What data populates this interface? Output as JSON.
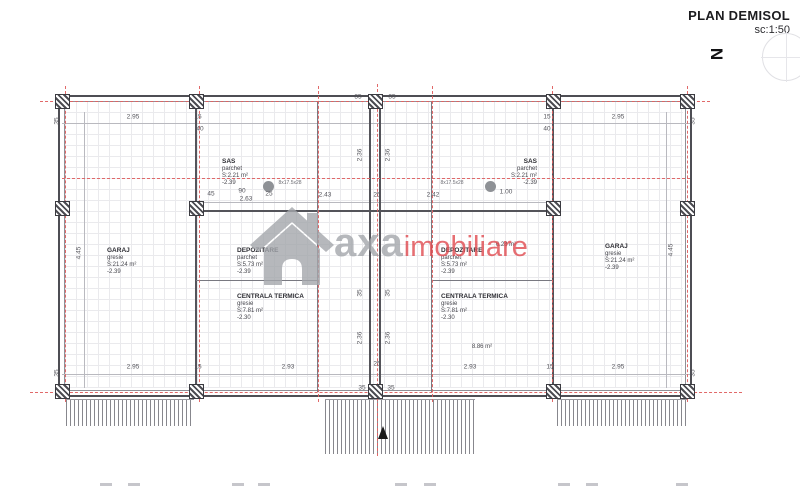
{
  "header": {
    "title": "PLAN DEMISOL",
    "scale": "sc:1:50",
    "north_letter": "N"
  },
  "watermark": {
    "brand": "axa",
    "suffix": "imobiliare",
    "grey_color": "#a4a7ac",
    "red_color": "#e04a50"
  },
  "rooms": [
    {
      "name": "GARAJ",
      "finish": "gresie",
      "area": "S:21.24 m²",
      "level": "-2.39",
      "x": 107,
      "y": 247,
      "align": "left"
    },
    {
      "name": "DEPOZITARE",
      "finish": "parchet",
      "area": "S:5.73 m²",
      "level": "-2.39",
      "x": 237,
      "y": 247,
      "align": "left"
    },
    {
      "name": "CENTRALA TERMICA",
      "finish": "gresie",
      "area": "S:7.81 m²",
      "level": "-2.30",
      "x": 237,
      "y": 293,
      "align": "left"
    },
    {
      "name": "SAS",
      "finish": "parchet",
      "area": "S:2.21 m²",
      "level": "-2.39",
      "x": 222,
      "y": 158,
      "align": "left"
    },
    {
      "name": "SAS",
      "finish": "parchet",
      "area": "S:2.21 m²",
      "level": "-2.39",
      "x": 537,
      "y": 158,
      "align": "right"
    },
    {
      "name": "DEPOZITARE",
      "finish": "parchet",
      "area": "S:5.73 m²",
      "level": "-2.39",
      "x": 441,
      "y": 247,
      "align": "left"
    },
    {
      "name": "CENTRALA TERMICA",
      "finish": "gresie",
      "area": "S:7.81 m²",
      "level": "-2.30",
      "x": 441,
      "y": 293,
      "align": "left"
    },
    {
      "name": "GARAJ",
      "finish": "gresie",
      "area": "S:21.24 m²",
      "level": "-2.39",
      "x": 605,
      "y": 243,
      "align": "left"
    }
  ],
  "annotations": [
    {
      "text": "6.28 m²",
      "x": 506,
      "y": 245,
      "small": 0
    },
    {
      "text": "8.86 m²",
      "x": 482,
      "y": 347,
      "small": 0
    },
    {
      "text": "8x17.5x28",
      "x": 290,
      "y": 183,
      "small": 1
    },
    {
      "text": "8x17.5x28",
      "x": 452,
      "y": 183,
      "small": 1
    }
  ],
  "dim_labels": [
    {
      "t": "2.95",
      "x": 133,
      "y": 117
    },
    {
      "t": "15",
      "x": 198,
      "y": 117
    },
    {
      "t": "15",
      "x": 547,
      "y": 117
    },
    {
      "t": "2.95",
      "x": 618,
      "y": 117
    },
    {
      "t": "35",
      "x": 57,
      "y": 121,
      "r": 1
    },
    {
      "t": "35",
      "x": 693,
      "y": 121,
      "r": 1
    },
    {
      "t": "40",
      "x": 200,
      "y": 129
    },
    {
      "t": "40",
      "x": 547,
      "y": 129
    },
    {
      "t": "35",
      "x": 358,
      "y": 97
    },
    {
      "t": "35",
      "x": 392,
      "y": 97
    },
    {
      "t": "45",
      "x": 211,
      "y": 194
    },
    {
      "t": "90",
      "x": 242,
      "y": 191
    },
    {
      "t": "2.63",
      "x": 246,
      "y": 199
    },
    {
      "t": "25",
      "x": 269,
      "y": 194
    },
    {
      "t": "2.43",
      "x": 325,
      "y": 195
    },
    {
      "t": "25",
      "x": 377,
      "y": 195
    },
    {
      "t": "2.42",
      "x": 433,
      "y": 195
    },
    {
      "t": "1.00",
      "x": 506,
      "y": 192
    },
    {
      "t": "4.45",
      "x": 79,
      "y": 253,
      "r": 1
    },
    {
      "t": "4.45",
      "x": 671,
      "y": 250,
      "r": 1
    },
    {
      "t": "2.36",
      "x": 360,
      "y": 155,
      "r": 1
    },
    {
      "t": "2.36",
      "x": 388,
      "y": 155,
      "r": 1
    },
    {
      "t": "35",
      "x": 360,
      "y": 293,
      "r": 1
    },
    {
      "t": "35",
      "x": 388,
      "y": 293,
      "r": 1
    },
    {
      "t": "2.36",
      "x": 360,
      "y": 338,
      "r": 1
    },
    {
      "t": "2.36",
      "x": 388,
      "y": 338,
      "r": 1
    },
    {
      "t": "2.95",
      "x": 133,
      "y": 367
    },
    {
      "t": "15",
      "x": 198,
      "y": 367
    },
    {
      "t": "2.93",
      "x": 288,
      "y": 367
    },
    {
      "t": "25",
      "x": 377,
      "y": 364
    },
    {
      "t": "2.93",
      "x": 470,
      "y": 367
    },
    {
      "t": "15",
      "x": 550,
      "y": 367
    },
    {
      "t": "2.95",
      "x": 618,
      "y": 367
    },
    {
      "t": "35",
      "x": 57,
      "y": 373,
      "r": 1
    },
    {
      "t": "35",
      "x": 693,
      "y": 373,
      "r": 1
    },
    {
      "t": "35",
      "x": 362,
      "y": 388
    },
    {
      "t": "35",
      "x": 391,
      "y": 388
    }
  ],
  "plan": {
    "walls": [
      {
        "x": 195,
        "y": 102,
        "w": 2,
        "h": 290
      },
      {
        "x": 552,
        "y": 102,
        "w": 2,
        "h": 290
      },
      {
        "x": 369,
        "y": 102,
        "w": 2,
        "h": 290
      },
      {
        "x": 379,
        "y": 102,
        "w": 2,
        "h": 290
      },
      {
        "x": 196,
        "y": 210,
        "w": 358,
        "h": 2
      },
      {
        "x": 317,
        "y": 102,
        "w": 1,
        "h": 290,
        "thin": 1
      },
      {
        "x": 431,
        "y": 102,
        "w": 1,
        "h": 290,
        "thin": 1
      },
      {
        "x": 196,
        "y": 280,
        "w": 122,
        "h": 1,
        "thin": 1
      },
      {
        "x": 431,
        "y": 280,
        "w": 122,
        "h": 1,
        "thin": 1
      }
    ],
    "axes_h": [
      {
        "y": 101,
        "x1": 40,
        "x2": 710
      },
      {
        "y": 178,
        "x1": 62,
        "x2": 690
      },
      {
        "y": 392,
        "x1": 30,
        "x2": 742
      }
    ],
    "axes_v": [
      {
        "x": 65,
        "y1": 86,
        "y2": 402
      },
      {
        "x": 199,
        "y1": 86,
        "y2": 402
      },
      {
        "x": 318,
        "y1": 86,
        "y2": 402
      },
      {
        "x": 377,
        "y1": 84,
        "y2": 456
      },
      {
        "x": 432,
        "y1": 86,
        "y2": 402
      },
      {
        "x": 552,
        "y1": 86,
        "y2": 402
      },
      {
        "x": 687,
        "y1": 86,
        "y2": 402
      }
    ],
    "dimlines": [
      {
        "x": 62,
        "y": 123,
        "w": 628,
        "h": 1
      },
      {
        "x": 202,
        "y": 202,
        "w": 351,
        "h": 1
      },
      {
        "x": 62,
        "y": 374,
        "w": 628,
        "h": 1
      },
      {
        "x": 84,
        "y": 112,
        "w": 1,
        "h": 276
      },
      {
        "x": 666,
        "y": 112,
        "w": 1,
        "h": 276
      }
    ],
    "piers": [
      {
        "x": 62,
        "y": 101
      },
      {
        "x": 196,
        "y": 101
      },
      {
        "x": 375,
        "y": 101
      },
      {
        "x": 553,
        "y": 101
      },
      {
        "x": 687,
        "y": 101
      },
      {
        "x": 62,
        "y": 208
      },
      {
        "x": 196,
        "y": 208
      },
      {
        "x": 553,
        "y": 208
      },
      {
        "x": 687,
        "y": 208
      },
      {
        "x": 62,
        "y": 391
      },
      {
        "x": 196,
        "y": 391
      },
      {
        "x": 375,
        "y": 391
      },
      {
        "x": 553,
        "y": 391
      },
      {
        "x": 687,
        "y": 391
      }
    ],
    "circles": [
      {
        "x": 268,
        "y": 186
      },
      {
        "x": 490,
        "y": 186
      }
    ],
    "hatch_strips": [
      {
        "x": 66,
        "y": 399,
        "w": 128,
        "h": 26
      },
      {
        "x": 325,
        "y": 399,
        "w": 150,
        "h": 54
      },
      {
        "x": 557,
        "y": 399,
        "w": 131,
        "h": 26
      }
    ],
    "footer_marks": [
      {
        "x": 100,
        "y": 483,
        "w": 12
      },
      {
        "x": 128,
        "y": 483,
        "w": 12
      },
      {
        "x": 232,
        "y": 483,
        "w": 12
      },
      {
        "x": 258,
        "y": 483,
        "w": 12
      },
      {
        "x": 395,
        "y": 483,
        "w": 12
      },
      {
        "x": 424,
        "y": 483,
        "w": 12
      },
      {
        "x": 558,
        "y": 483,
        "w": 12
      },
      {
        "x": 586,
        "y": 483,
        "w": 12
      },
      {
        "x": 676,
        "y": 483,
        "w": 12
      }
    ]
  }
}
